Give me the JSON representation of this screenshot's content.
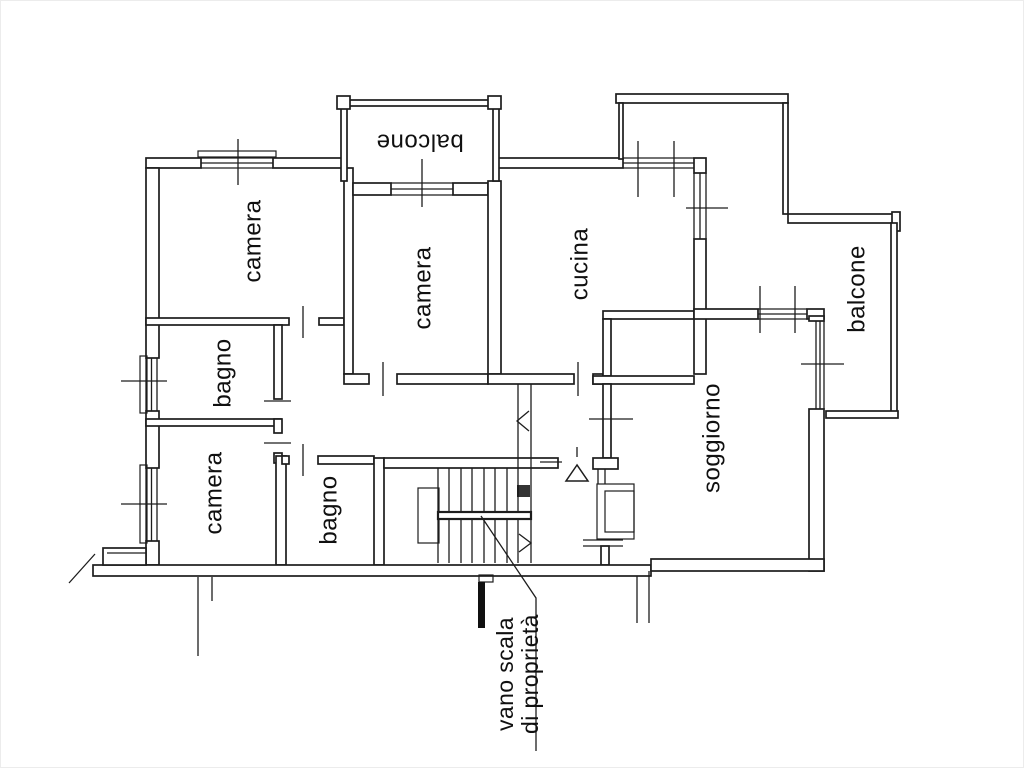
{
  "canvas": {
    "width": 1024,
    "height": 768,
    "background": "#ffffff",
    "line_color": "#1d1d1d"
  },
  "plan": {
    "kind": "apartment-floor-plan",
    "rooms": [
      {
        "id": "camera-top-left",
        "label": "camera"
      },
      {
        "id": "bagno-upper",
        "label": "bagno"
      },
      {
        "id": "camera-lower",
        "label": "camera"
      },
      {
        "id": "bagno-lower",
        "label": "bagno"
      },
      {
        "id": "camera-middle",
        "label": "camera"
      },
      {
        "id": "cucina",
        "label": "cucina"
      },
      {
        "id": "soggiorno",
        "label": "soggiorno"
      },
      {
        "id": "balcone-top",
        "label": "balcone"
      },
      {
        "id": "balcone-right",
        "label": "balcone"
      }
    ],
    "stair_note": {
      "line1": "vano scala",
      "line2": "di proprietà"
    }
  }
}
